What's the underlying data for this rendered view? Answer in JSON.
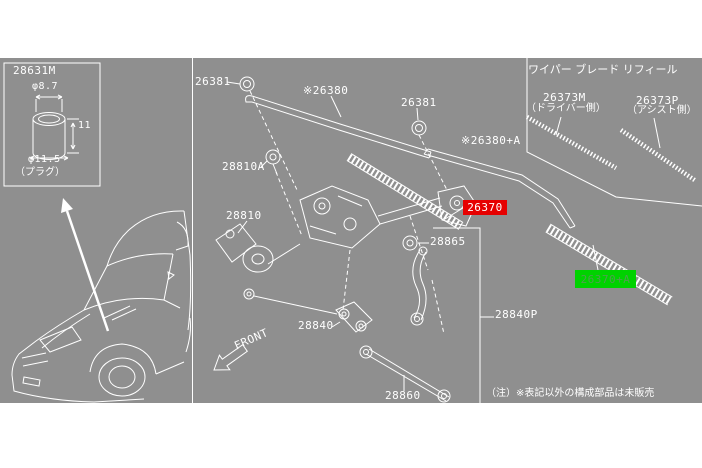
{
  "colors": {
    "background": "#ffffff",
    "diagram_panel": "#8f8f8f",
    "line_art": "#ffffff",
    "highlight_selected": "#e60000",
    "highlight_related": "#00d200",
    "label_text": "#ffffff"
  },
  "inset": {
    "part_no": "28631M",
    "dim_top": "φ8.7",
    "dim_side": "11",
    "dim_bottom": "φ11.5",
    "caption": "（プラグ）"
  },
  "front_label": "FRONT",
  "parts": {
    "pivot_cap_1": "26381",
    "pivot_cap_2": "26381",
    "wiper_arm_driver": "※26380",
    "wiper_arm_assist": "※26380+A",
    "pivot_bolt": "28810A",
    "wiper_motor": "28810",
    "wiper_blade_driver": "26370",
    "blade_stud": "28865",
    "link_bracket": "28840",
    "link_rod": "28860",
    "pivot_assembly": "28840P",
    "wiper_blade_assist": "26370+A"
  },
  "refill_panel": {
    "title": "ワイパー ブレード リフィール",
    "driver_part_no": "26373M",
    "driver_side_label": "（ドライバー側）",
    "assist_part_no": "26373P",
    "assist_side_label": "（アシスト側）"
  },
  "note": "（注）※表記以外の構成部品は未販売"
}
